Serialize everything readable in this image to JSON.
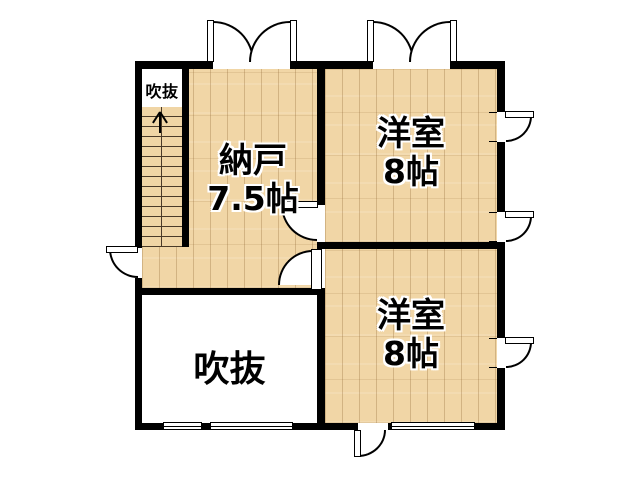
{
  "floor_plan": {
    "labels": {
      "stairwell_void": "吹抜",
      "storage_name": "納戸",
      "storage_size": "7.5帖",
      "western_top_name": "洋室",
      "western_top_size": "8帖",
      "western_bottom_name": "洋室",
      "western_bottom_size": "8帖",
      "void_room": "吹抜"
    },
    "icons": {
      "stair_direction": "up-arrow"
    },
    "colors": {
      "wall": "#000000",
      "wood_floor": "#f1d6a6",
      "plank_line": "#8b6230",
      "void_floor": "#ffffff",
      "door_window_fill": "#ffffff"
    }
  }
}
